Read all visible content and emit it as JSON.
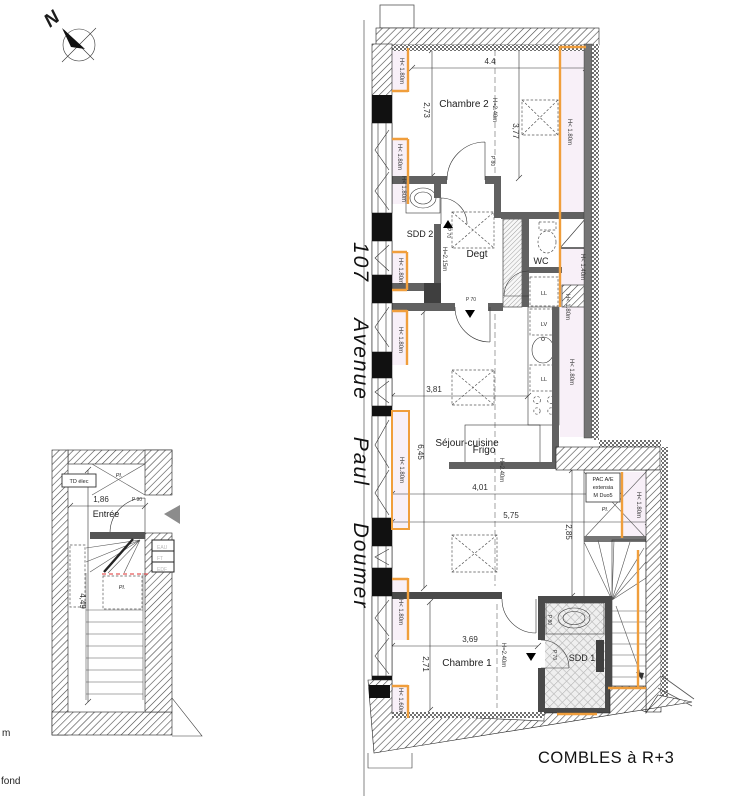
{
  "plan": {
    "caption": "COMBLES à R+3",
    "street": "107 Avenue Paul Doumer",
    "north": "N"
  },
  "rooms": {
    "chambre2": "Chambre 2",
    "sdd2": "SDD 2",
    "degt": "Degt",
    "wc": "WC",
    "sejour_cuisine": "Séjour-cuisine",
    "frigo": "Frigo",
    "chambre1": "Chambre 1",
    "sdd1": "SDD 1",
    "entree": "Entrée"
  },
  "equipment": {
    "ll": "LL",
    "lv": "LV",
    "pac_l1": "PAC A/E",
    "pac_l2": "extensia",
    "pac_l3": "M Duo5",
    "pl": "Pl.",
    "td_elec": "TD élec",
    "eau": "EAU",
    "ft": "FT",
    "edf": "EDF"
  },
  "dims": {
    "d44": "4.4",
    "d273": "2,73",
    "d377": "3,77",
    "d381": "3,81",
    "d645": "6,45",
    "d401": "4,01",
    "d575": "5,75",
    "d285": "2,85",
    "d369": "3,69",
    "d271": "2,71",
    "d186": "1,86",
    "d449": "4,49"
  },
  "heights": {
    "h240": "H=2.40m",
    "h215": "H=2.15m",
    "h180": "H< 1.80m",
    "h160": "H< 1.60m",
    "h140": "H< 1.40m"
  },
  "doors": {
    "p80": "P 80",
    "p70": "P 70",
    "p90": "P 90"
  },
  "misc": {
    "m": "m",
    "fond": "fond"
  },
  "colors": {
    "low_height_fill": "#f8f0f8",
    "low_height_line": "#f09e3c",
    "wall_gray": "#757575",
    "red_dash": "#e03030"
  }
}
